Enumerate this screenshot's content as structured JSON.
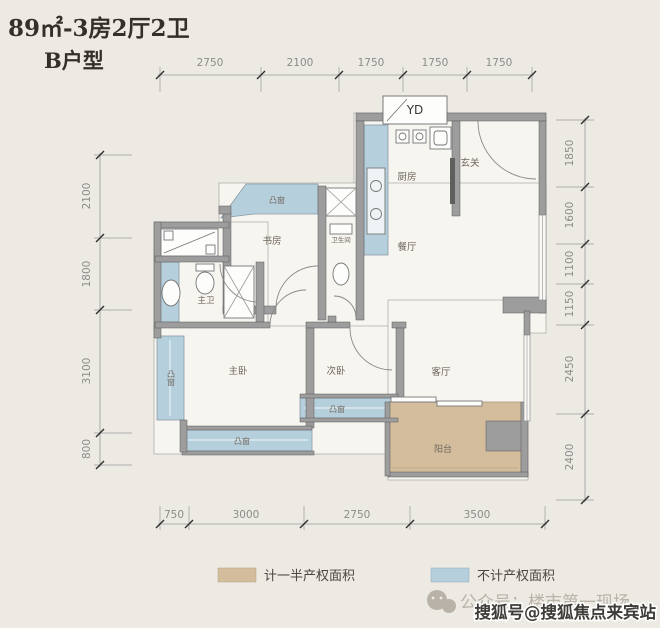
{
  "title": {
    "area_type": "89㎡-3房2厅2卫",
    "unit": "B户型"
  },
  "dimensions": {
    "top": [
      "2750",
      "2100",
      "1750",
      "1750",
      "1750"
    ],
    "bottom": [
      "750",
      "3000",
      "2750",
      "3500"
    ],
    "left": [
      "2100",
      "1800",
      "3100",
      "800"
    ],
    "right": [
      "1850",
      "1600",
      "1100",
      "1150",
      "2450",
      "2400"
    ]
  },
  "rooms": {
    "yd": "YD",
    "kitchen": "厨房",
    "entry": "玄关",
    "study": "书房",
    "bathroom": "卫生间",
    "dining": "餐厅",
    "master_bath": "主卫",
    "master_bed": "主卧",
    "second_bed": "次卧",
    "living": "客厅",
    "balcony": "阳台",
    "bay": "凸窗"
  },
  "legend": {
    "half_area": {
      "label": "计一半产权面积",
      "color": "#d3bd9d"
    },
    "no_area": {
      "label": "不计产权面积",
      "color": "#b6cfdd"
    }
  },
  "watermarks": {
    "wechat": "公众号：楼市第一现场",
    "sohu": "搜狐号@搜狐焦点来宾站"
  },
  "colors": {
    "background": "#edeae3",
    "wall": "#9d9d9d",
    "floor": "#f7f5f0",
    "bay_blue": "#b6cfdd",
    "balcony_tan": "#d3bd9d"
  }
}
